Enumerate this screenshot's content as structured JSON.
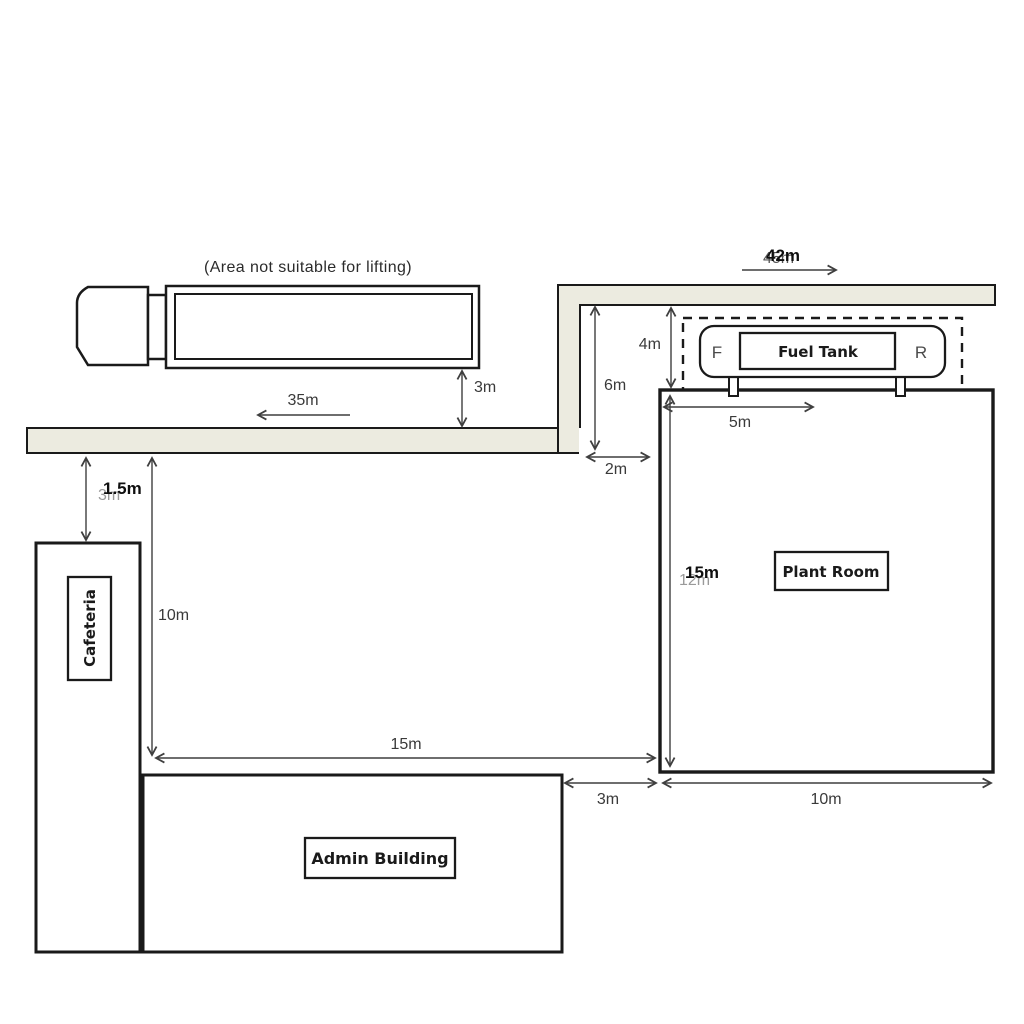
{
  "note": "(Area not suitable for lifting)",
  "buildings": {
    "cafeteria": "Cafeteria",
    "admin": "Admin Building",
    "plant_room": "Plant Room"
  },
  "fuel_tank": {
    "label": "Fuel Tank",
    "front": "F",
    "rear": "R"
  },
  "dims": {
    "road_run_left": "35m",
    "truck_to_road": "3m",
    "road_to_cafeteria": "1.5m",
    "road_to_cafeteria_old": "3m",
    "cafeteria_side": "10m",
    "yard_width": "15m",
    "admin_to_plant": "3m",
    "plant_width": "10m",
    "plant_depth": "15m",
    "plant_depth_old": "12m",
    "tank_offset": "5m",
    "road_to_plant": "4m",
    "road_to_plant_outer": "6m",
    "road_end_gap": "2m",
    "road_run_top": "42m",
    "road_run_top_old": "45m"
  },
  "colors": {
    "road_fill": "#ECEBE0"
  }
}
